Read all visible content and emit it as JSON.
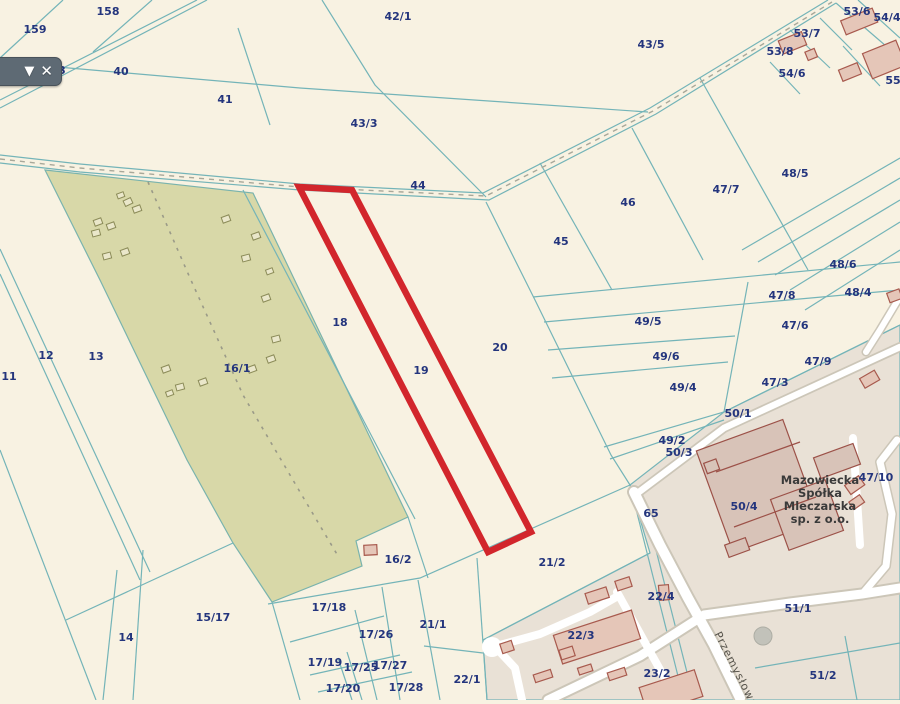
{
  "map": {
    "name": "cadastral-parcel-map",
    "colors": {
      "background": "#f8f2e2",
      "forest_fill": "#d8d8a8",
      "parcel_line": "#74b4b8",
      "label_navy": "#24357d",
      "selected_outline": "#d2262c",
      "built_zone": "#e9e1d6",
      "building_fill": "#e5c6b8",
      "building_stroke": "#a85a4e",
      "road_fill": "#ffffff"
    },
    "toolbar": {
      "collapse_icon": "chevron-down",
      "close_icon": "close"
    },
    "selected_parcel": {
      "number": "19"
    },
    "street_label": "Przemysłowa",
    "company_label": {
      "lines": [
        "Mazowiecka",
        "Spółka",
        "Mleczarska",
        "sp. z o.o."
      ]
    },
    "parcel_labels": [
      {
        "text": "159",
        "x": 35,
        "y": 30
      },
      {
        "text": "158",
        "x": 108,
        "y": 12
      },
      {
        "text": "40",
        "x": 121,
        "y": 72
      },
      {
        "text": "41",
        "x": 225,
        "y": 100
      },
      {
        "text": "42/1",
        "x": 398,
        "y": 17
      },
      {
        "text": "43/5",
        "x": 651,
        "y": 45
      },
      {
        "text": "43/3",
        "x": 364,
        "y": 124
      },
      {
        "text": "44",
        "x": 418,
        "y": 186
      },
      {
        "text": "45",
        "x": 561,
        "y": 242
      },
      {
        "text": "46",
        "x": 628,
        "y": 203
      },
      {
        "text": "53/6",
        "x": 857,
        "y": 12
      },
      {
        "text": "54/4",
        "x": 887,
        "y": 18
      },
      {
        "text": "53/7",
        "x": 807,
        "y": 34
      },
      {
        "text": "53/8",
        "x": 780,
        "y": 52
      },
      {
        "text": "54/6",
        "x": 792,
        "y": 74
      },
      {
        "text": "55",
        "x": 893,
        "y": 81
      },
      {
        "text": "47/7",
        "x": 726,
        "y": 190
      },
      {
        "text": "48/5",
        "x": 795,
        "y": 174
      },
      {
        "text": "48/6",
        "x": 843,
        "y": 265
      },
      {
        "text": "48/4",
        "x": 858,
        "y": 293
      },
      {
        "text": "47/8",
        "x": 782,
        "y": 296
      },
      {
        "text": "47/6",
        "x": 795,
        "y": 326
      },
      {
        "text": "49/5",
        "x": 648,
        "y": 322
      },
      {
        "text": "49/6",
        "x": 666,
        "y": 357
      },
      {
        "text": "49/4",
        "x": 683,
        "y": 388
      },
      {
        "text": "47/9",
        "x": 818,
        "y": 362
      },
      {
        "text": "47/3",
        "x": 775,
        "y": 383
      },
      {
        "text": "50/1",
        "x": 738,
        "y": 414
      },
      {
        "text": "49/2",
        "x": 672,
        "y": 441
      },
      {
        "text": "50/3",
        "x": 679,
        "y": 453
      },
      {
        "text": "47/10",
        "x": 876,
        "y": 478
      },
      {
        "text": "50/4",
        "x": 744,
        "y": 507
      },
      {
        "text": "65",
        "x": 651,
        "y": 514
      },
      {
        "text": "51/1",
        "x": 798,
        "y": 609
      },
      {
        "text": "51/2",
        "x": 823,
        "y": 676
      },
      {
        "text": "18",
        "x": 340,
        "y": 323
      },
      {
        "text": "19",
        "x": 421,
        "y": 371
      },
      {
        "text": "20",
        "x": 500,
        "y": 348
      },
      {
        "text": "16/1",
        "x": 237,
        "y": 369
      },
      {
        "text": "13",
        "x": 96,
        "y": 357
      },
      {
        "text": "12",
        "x": 46,
        "y": 356
      },
      {
        "text": "11",
        "x": 9,
        "y": 377
      },
      {
        "text": "14",
        "x": 126,
        "y": 638
      },
      {
        "text": "15/17",
        "x": 213,
        "y": 618
      },
      {
        "text": "16/2",
        "x": 398,
        "y": 560
      },
      {
        "text": "21/2",
        "x": 552,
        "y": 563
      },
      {
        "text": "21/1",
        "x": 433,
        "y": 625
      },
      {
        "text": "22/1",
        "x": 467,
        "y": 680
      },
      {
        "text": "17/18",
        "x": 329,
        "y": 608
      },
      {
        "text": "17/26",
        "x": 376,
        "y": 635
      },
      {
        "text": "17/19",
        "x": 325,
        "y": 663
      },
      {
        "text": "17/25",
        "x": 361,
        "y": 668
      },
      {
        "text": "17/27",
        "x": 390,
        "y": 666
      },
      {
        "text": "17/20",
        "x": 343,
        "y": 689
      },
      {
        "text": "17/28",
        "x": 406,
        "y": 688
      },
      {
        "text": "22/3",
        "x": 581,
        "y": 636
      },
      {
        "text": "22/4",
        "x": 661,
        "y": 597
      },
      {
        "text": "23/2",
        "x": 657,
        "y": 674
      },
      {
        "text": "3",
        "x": 62,
        "y": 71
      }
    ]
  }
}
